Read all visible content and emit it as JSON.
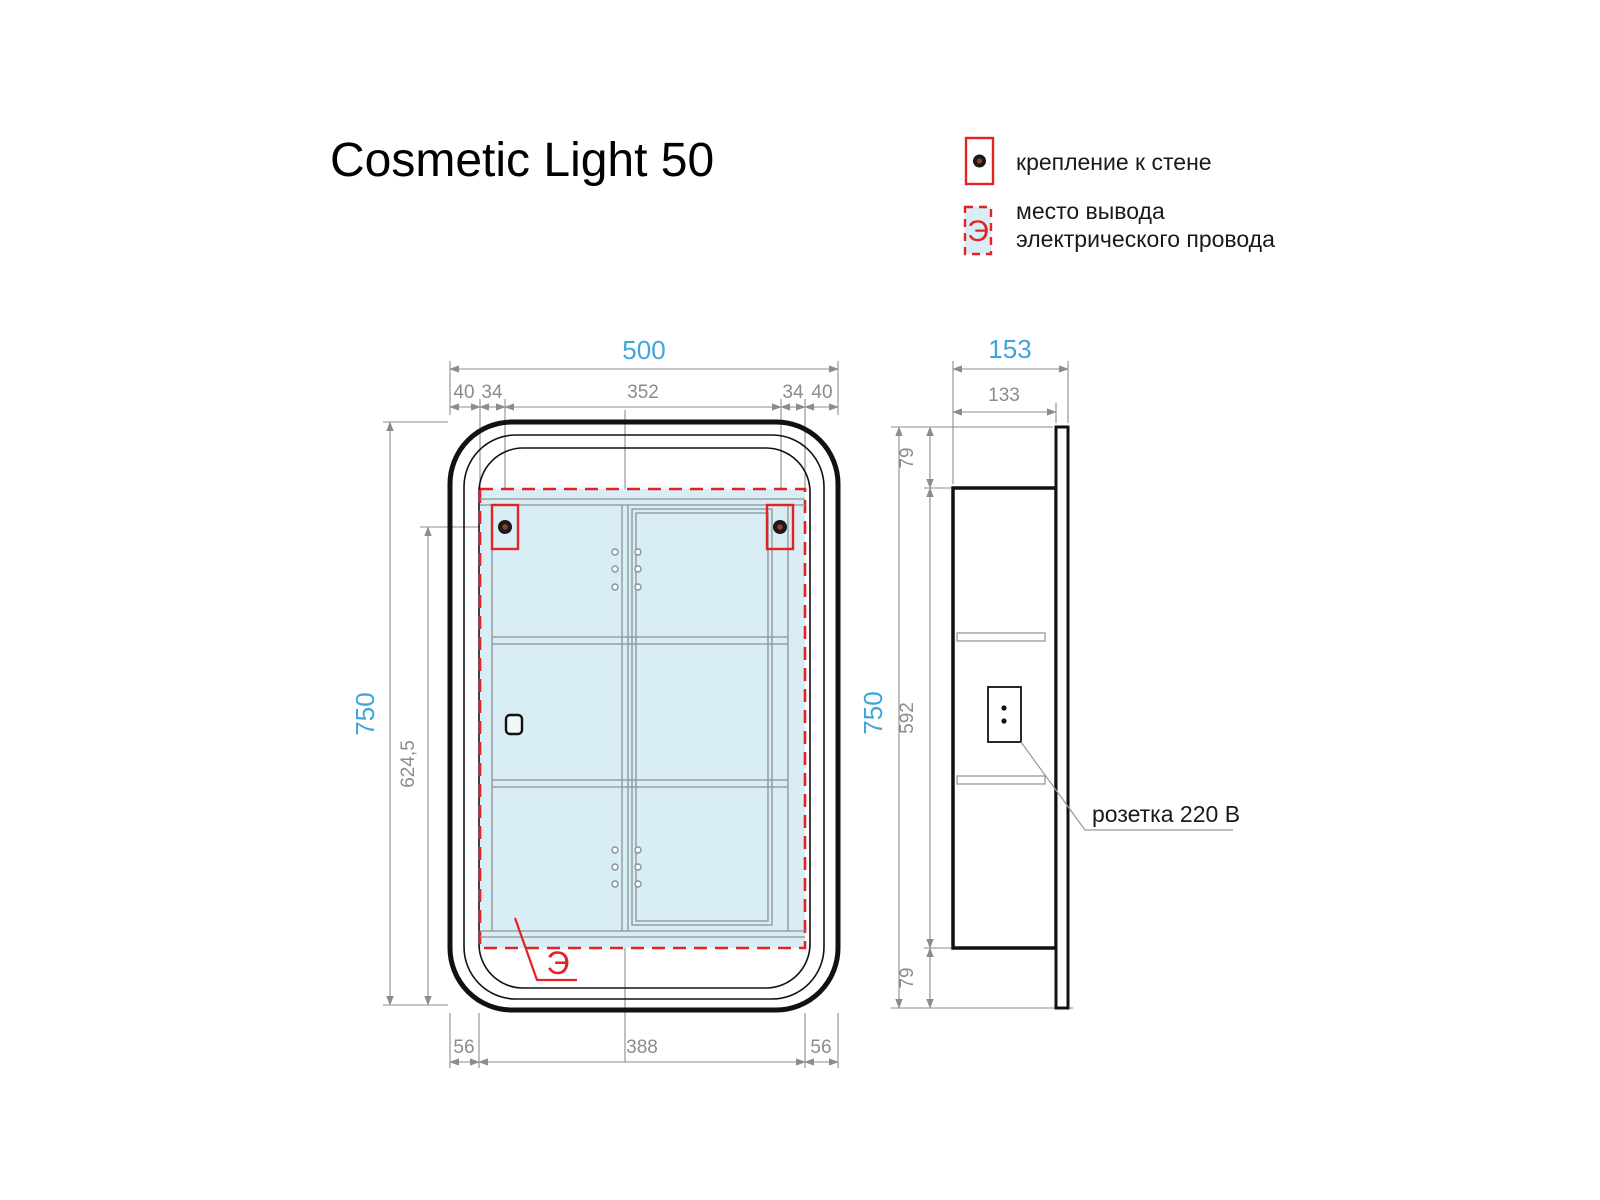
{
  "title": "Cosmetic Light 50",
  "legend": {
    "wall_mount": "крепление к стене",
    "electric_line1": "место вывода",
    "electric_line2": "электрического провода",
    "symbol": "Э"
  },
  "front": {
    "dim_width_total": "500",
    "dim_top": [
      "40",
      "34",
      "352",
      "34",
      "40"
    ],
    "dim_height_total": "750",
    "dim_mount_height": "624,5",
    "dim_bottom": [
      "56",
      "388",
      "56"
    ],
    "electric_symbol": "Э"
  },
  "side": {
    "dim_depth_total": "153",
    "dim_body_depth": "133",
    "dim_top_offset": "79",
    "dim_body_height": "592",
    "dim_bottom_offset": "79",
    "dim_height_total": "750",
    "socket_label": "розетка 220 В"
  },
  "colors": {
    "dim_blue": "#3FA5DC",
    "dim_gray": "#8C8C8C",
    "accent_red": "#E32226",
    "interior_fill": "#D9EDF5"
  }
}
